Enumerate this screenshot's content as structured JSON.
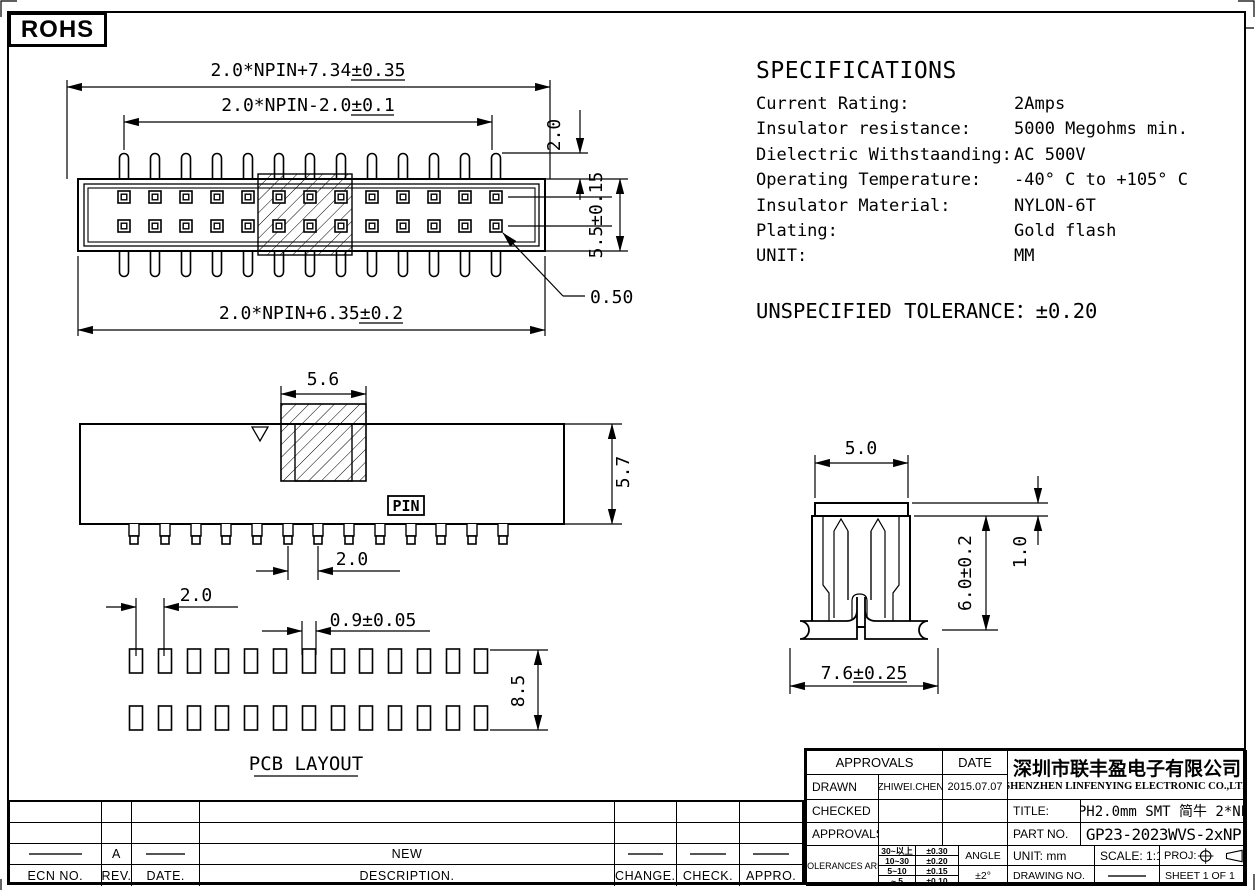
{
  "page": {
    "rohs": "ROHS"
  },
  "specs": {
    "title": "SPECIFICATIONS",
    "rows": [
      {
        "label": "Current Rating:",
        "value": "2Amps"
      },
      {
        "label": "Insulator resistance:",
        "value": "5000 Megohms min."
      },
      {
        "label": "Dielectric Withstaanding:",
        "value": "AC 500V"
      },
      {
        "label": "Operating Temperature:",
        "value": "-40° C to +105° C"
      },
      {
        "label": "Insulator Material:",
        "value": "NYLON-6T"
      },
      {
        "label": "Plating:",
        "value": "Gold flash"
      },
      {
        "label": "UNIT:",
        "value": "MM"
      }
    ],
    "unspecified_tolerance": "UNSPECIFIED TOLERANCE：±0.20"
  },
  "top_view": {
    "dim_total": "2.0*NPIN+7.34±0.35",
    "dim_pins": "2.0*NPIN-2.0±0.1",
    "dim_body": "2.0*NPIN+6.35±0.2",
    "dim_pin_protrusion": "2.0",
    "dim_height": "5.5±0.15",
    "dim_pad": "0.50"
  },
  "side_view": {
    "dim_tab_width": "5.6",
    "dim_height": "5.7",
    "dim_pitch": "2.0",
    "pin_label": "PIN"
  },
  "pcb_layout": {
    "title": "PCB LAYOUT",
    "dim_pitch": "2.0",
    "dim_pad_width": "0.9±0.05",
    "dim_row_span": "8.5"
  },
  "end_view": {
    "dim_top_width": "5.0",
    "dim_cap_height": "1.0",
    "dim_body_height": "6.0±0.2",
    "dim_total_width": "7.6±0.25"
  },
  "title_block": {
    "approvals_header": "APPROVALS",
    "date_header": "DATE",
    "drawn_label": "DRAWN",
    "drawn_name": "ZHIWEI.CHEN",
    "drawn_date": "2015.07.07",
    "checked_label": "CHECKED",
    "approvals_label": "APPROVALS",
    "tolerances_label": "TOLERANCES ARE",
    "tolerance_rows": [
      {
        "range": "30~以上",
        "tol": "±0.30"
      },
      {
        "range": "10~30",
        "tol": "±0.20"
      },
      {
        "range": "5~10",
        "tol": "±0.15"
      },
      {
        "range": "~ 5",
        "tol": "±0.10"
      }
    ],
    "angle_label": "ANGLE",
    "angle_tol": "±2°",
    "company_cn": "深圳市联丰盈电子有限公司",
    "company_en": "SHENZHEN LINFENYING ELECTRONIC CO.,LTD",
    "title_label": "TITLE:",
    "title_value": "PH2.0mm SMT 简牛 2*NP",
    "part_label": "PART NO.",
    "part_value": "GP23-2023WVS-2xNP",
    "unit_label": "UNIT: mm",
    "scale_label": "SCALE: 1:1",
    "proj_label": "PROJ:",
    "drawing_no_label": "DRAWING NO.",
    "sheet_label": "SHEET 1 OF 1"
  },
  "revision_table": {
    "headers": [
      "ECN NO.",
      "REV.",
      "DATE.",
      "DESCRIPTION.",
      "CHANGE.",
      "CHECK.",
      "APPRO."
    ],
    "rows": [
      {
        "ecn": "",
        "rev": "",
        "date": "",
        "description": "",
        "change": "",
        "check": "",
        "appro": ""
      },
      {
        "ecn": "",
        "rev": "",
        "date": "",
        "description": "",
        "change": "",
        "check": "",
        "appro": ""
      },
      {
        "ecn": "-",
        "rev": "A",
        "date": "-",
        "description": "NEW",
        "change": "-",
        "check": "-",
        "appro": "-"
      }
    ]
  }
}
